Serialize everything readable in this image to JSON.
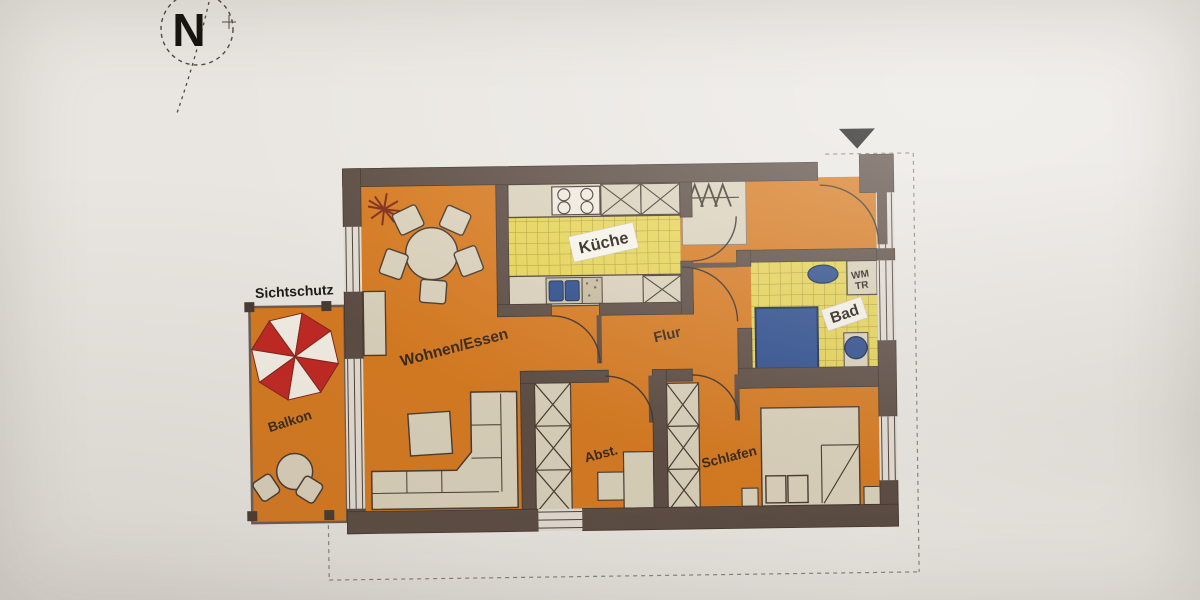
{
  "floor_plan": {
    "rooms": [
      {
        "id": "balkon",
        "label": "Balkon"
      },
      {
        "id": "wohnen-essen",
        "label": "Wohnen/Essen"
      },
      {
        "id": "kueche",
        "label": "Küche"
      },
      {
        "id": "flur",
        "label": "Flur"
      },
      {
        "id": "bad",
        "label": "Bad"
      },
      {
        "id": "abstellraum",
        "label": "Abst."
      },
      {
        "id": "schlafen",
        "label": "Schlafen"
      }
    ],
    "annotations": {
      "sichtschutz": "Sichtschutz",
      "washer_dryer_line1": "WM",
      "washer_dryer_line2": "TR",
      "compass": "N"
    },
    "colors": {
      "paper": "#e9e6e1",
      "wall": "#5a4a41",
      "floor_orange": "#d5781e",
      "tile_yellow": "#e5d356",
      "tile_grid": "#a6952f",
      "furniture_beige": "#d9d0ba",
      "fixture_blue": "#2a4b8b",
      "parasol_red": "#c02520",
      "label_white": "#f6f2e9"
    },
    "icons": [
      "north-compass-icon",
      "entrance-triangle-marker",
      "parasol-icon",
      "coat-hooks-icon",
      "plant-icon",
      "stove-icon",
      "shower-icon",
      "toilet-icon",
      "sink-icon"
    ]
  }
}
